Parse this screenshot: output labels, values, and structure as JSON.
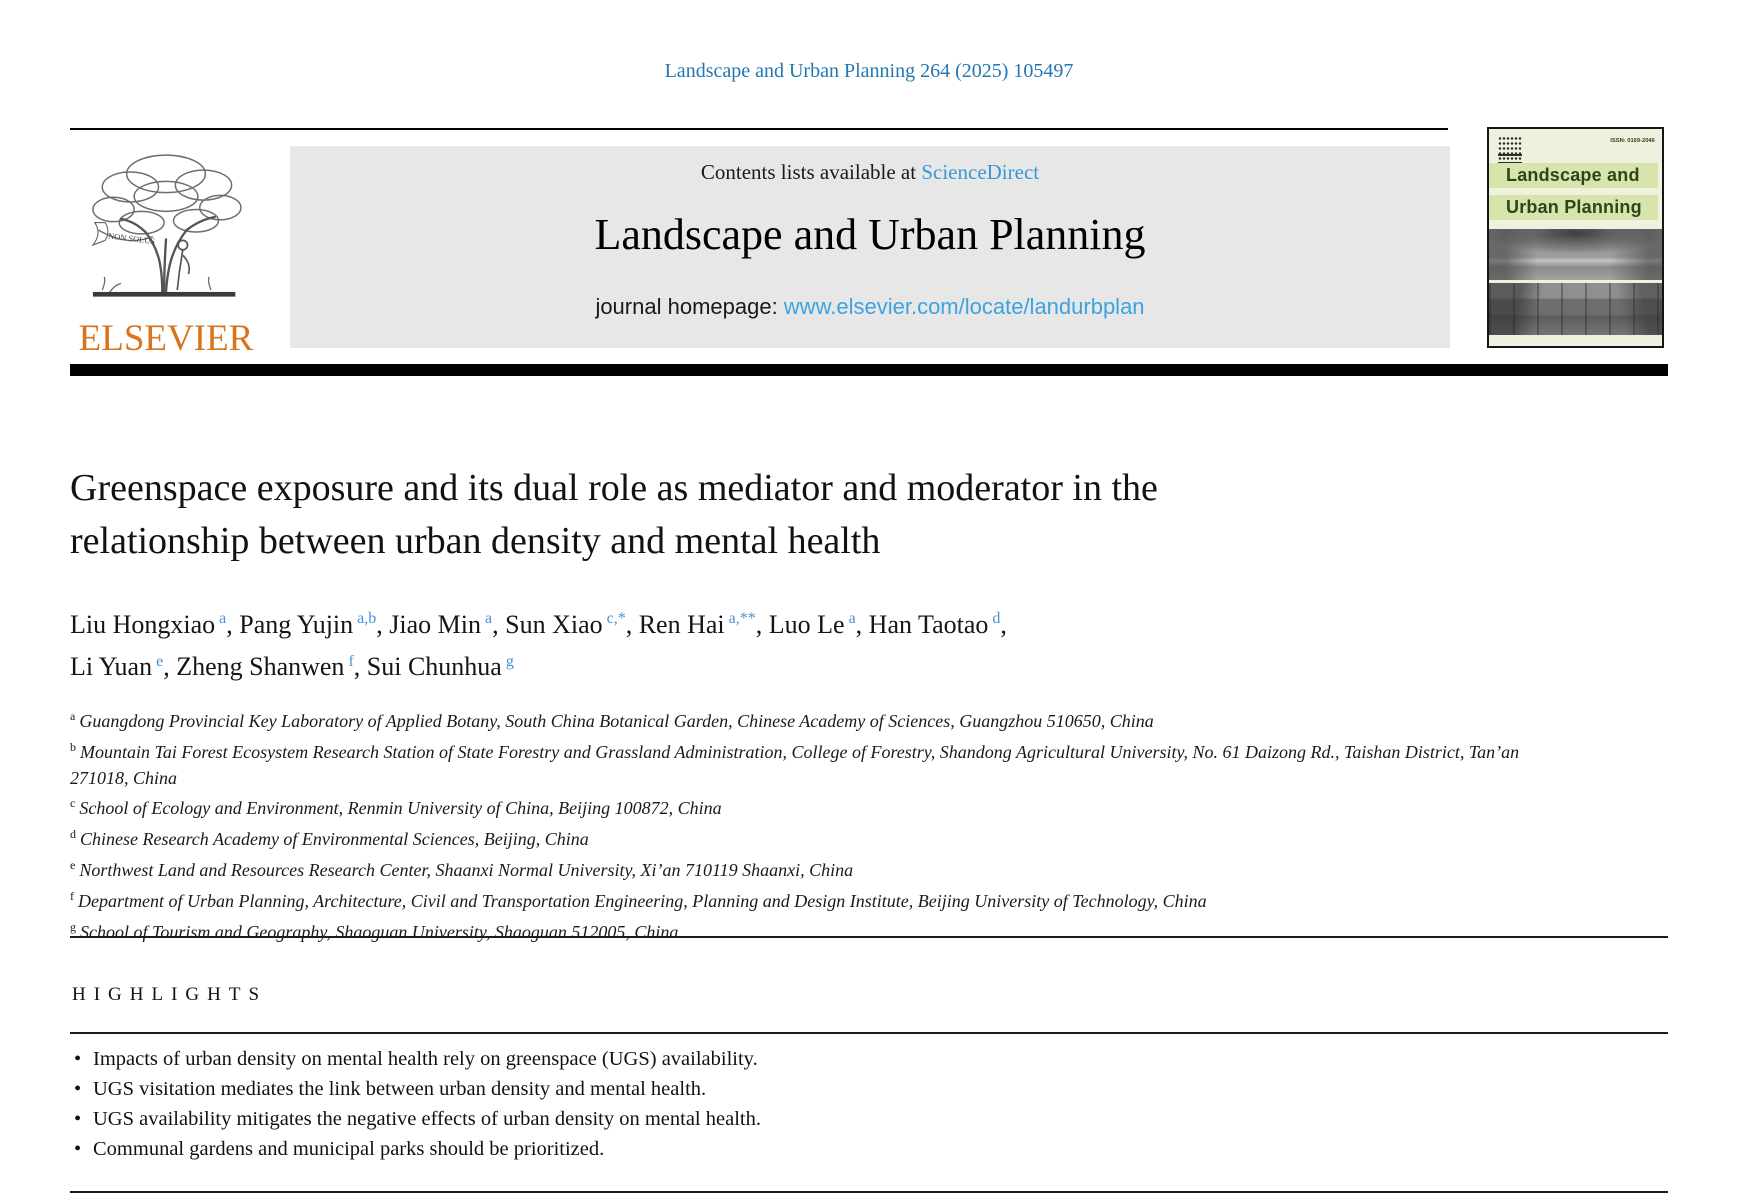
{
  "page": {
    "citation": "Landscape and Urban Planning 264 (2025) 105497"
  },
  "publisher": {
    "name": "ELSEVIER",
    "motto": "NON SOLUS"
  },
  "banner": {
    "contents_prefix": "Contents lists available at ",
    "contents_link": "ScienceDirect",
    "journal_title": "Landscape and Urban Planning",
    "homepage_prefix": "journal homepage: ",
    "homepage_link": "www.elsevier.com/locate/landurbplan"
  },
  "cover": {
    "title_line1": "Landscape and",
    "title_line2": "Urban Planning",
    "issn": "ISSN: 0169-2046"
  },
  "article": {
    "title_line1": "Greenspace exposure and its dual role as mediator and moderator in the",
    "title_line2": "relationship between urban density and mental health",
    "authors": [
      {
        "name": "Liu Hongxiao",
        "sup": "a",
        "sep": ", "
      },
      {
        "name": "Pang Yujin",
        "sup": "a,b",
        "sep": ", "
      },
      {
        "name": "Jiao Min",
        "sup": "a",
        "sep": ", "
      },
      {
        "name": "Sun Xiao",
        "sup": "c,*",
        "sep": ", "
      },
      {
        "name": "Ren Hai",
        "sup": "a,**",
        "sep": ", "
      },
      {
        "name": "Luo Le",
        "sup": "a",
        "sep": ", "
      },
      {
        "name": "Han Taotao",
        "sup": "d",
        "sep": ","
      },
      {
        "name": "Li Yuan",
        "sup": "e",
        "sep": ", ",
        "break_before": true
      },
      {
        "name": "Zheng Shanwen",
        "sup": "f",
        "sep": ", "
      },
      {
        "name": "Sui Chunhua",
        "sup": "g",
        "sep": ""
      }
    ],
    "affiliations": [
      {
        "label": "a",
        "text": "Guangdong Provincial Key Laboratory of Applied Botany, South China Botanical Garden, Chinese Academy of Sciences, Guangzhou 510650, China"
      },
      {
        "label": "b",
        "text": "Mountain Tai Forest Ecosystem Research Station of State Forestry and Grassland Administration, College of Forestry, Shandong Agricultural University, No. 61 Daizong Rd., Taishan District, Tan’an 271018, China"
      },
      {
        "label": "c",
        "text": "School of Ecology and Environment, Renmin University of China, Beijing 100872, China"
      },
      {
        "label": "d",
        "text": "Chinese Research Academy of Environmental Sciences, Beijing, China"
      },
      {
        "label": "e",
        "text": "Northwest Land and Resources Research Center, Shaanxi Normal University, Xi’an 710119 Shaanxi, China"
      },
      {
        "label": "f",
        "text": "Department of Urban Planning, Architecture, Civil and Transportation Engineering, Planning and Design Institute, Beijing University of Technology, China"
      },
      {
        "label": "g",
        "text": "School of Tourism and Geography, Shaoguan University, Shaoguan 512005, China"
      }
    ]
  },
  "highlights": {
    "heading": "HIGHLIGHTS",
    "items": [
      "Impacts of urban density on mental health rely on greenspace (UGS) availability.",
      "UGS visitation mediates the link between urban density and mental health.",
      "UGS availability mitigates the negative effects of urban density on mental health.",
      "Communal gardens and municipal parks should be prioritized."
    ]
  },
  "colors": {
    "citation_blue": "#2277b2",
    "sciencedirect_blue": "#3799d4",
    "homepage_link_blue": "#3aa4e0",
    "superscript_blue": "#4a90d2",
    "elsevier_orange": "#d9731c",
    "banner_gray": "#e7e7e7",
    "cover_bg_green": "#edf1dd",
    "cover_bar_green": "#d7e4ab",
    "cover_text_green": "#2c451c"
  }
}
